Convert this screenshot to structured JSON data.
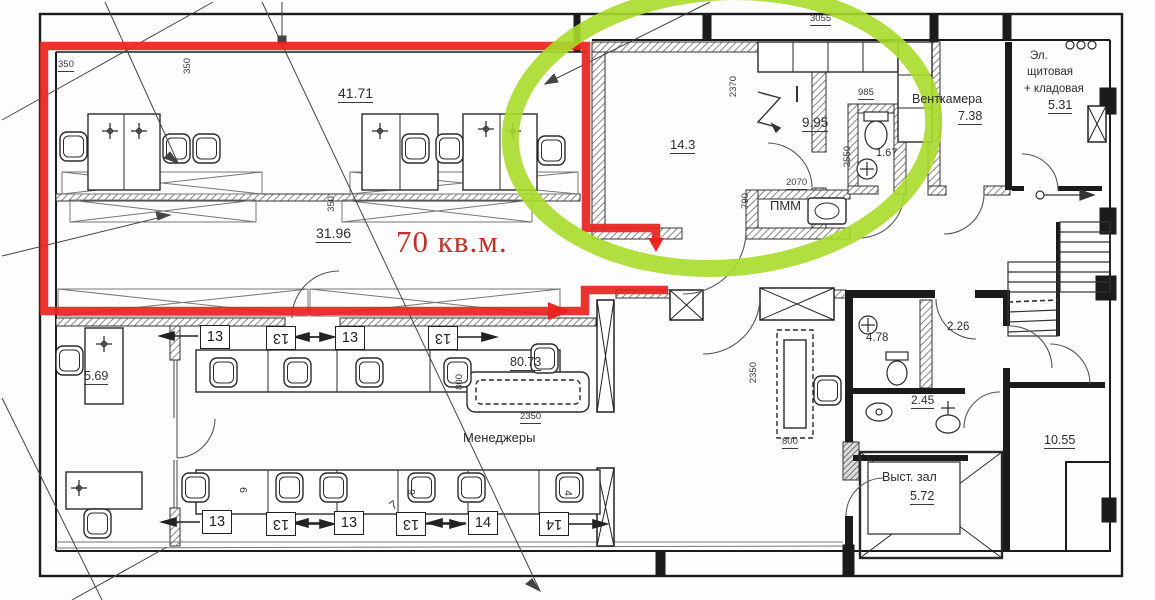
{
  "plan": {
    "callout": {
      "text": "70 кв.м."
    },
    "rooms": {
      "office_top_area": "41.71",
      "office_mid_area": "31.96",
      "meeting_area": "14.3",
      "kitchen_area": "9.95",
      "kitchen_wc_area": "1.67",
      "vent_name": "Венткамера",
      "vent_area": "7.38",
      "electrical_line1": "Эл.",
      "electrical_line2": "щитовая",
      "electrical_line3": "+ кладовая",
      "electrical_area": "5.31",
      "desk_area_569": "5.69",
      "open_space_area": "80.73",
      "managers_label": "Менеджеры",
      "pmm_label": "ПММ",
      "wc1_area": "4.78",
      "hall_area": "2.26",
      "wc2_area": "2.45",
      "exhibition_name": "Выст. зал",
      "exhibition_area": "5.72",
      "stair_room_area": "10.55"
    },
    "dims": {
      "d350a": "350",
      "d350b": "350",
      "d350c": "350",
      "d3055": "3055",
      "d2370": "2370",
      "d985": "985",
      "d2550": "2550",
      "d2070": "2070",
      "d790": "790",
      "d800a": "800",
      "d2350a": "2350",
      "d2350b": "2350",
      "d800b": "800"
    },
    "desk_tags": {
      "t1": "13",
      "t2": "13",
      "t3": "13",
      "t4": "13",
      "b1": "13",
      "b2": "13",
      "b3": "13",
      "b4": "13",
      "b5": "14",
      "b6": "14",
      "m7": "7",
      "m6": "6",
      "m9": "9",
      "m4": "4"
    },
    "colors": {
      "highlight_red": "#e8231e",
      "highlight_green": "#a9dc2a",
      "callout_red": "#c23126"
    }
  }
}
